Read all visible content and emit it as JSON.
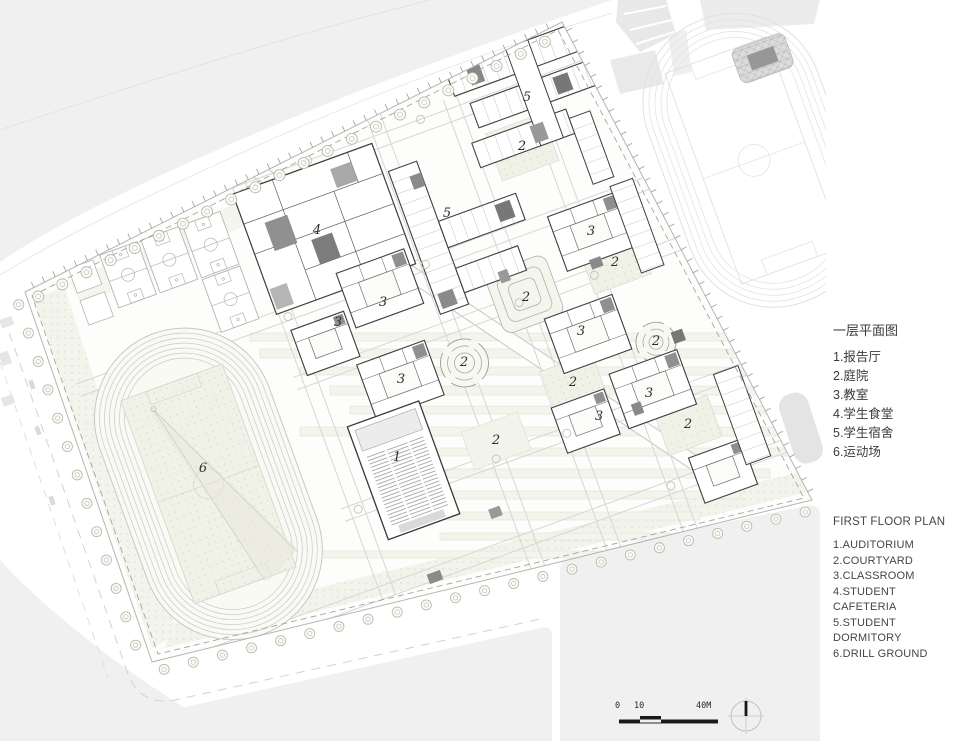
{
  "legend_zh": {
    "title": "一层平面图",
    "items": [
      "1.报告厅",
      "2.庭院",
      "3.教室",
      "4.学生食堂",
      "5.学生宿舍",
      "6.运动场"
    ]
  },
  "legend_en": {
    "title": "FIRST FLOOR PLAN",
    "items": [
      "1.AUDITORIUM",
      "2.COURTYARD",
      "3.CLASSROOM",
      "4.STUDENT CAFETERIA",
      "5.STUDENT DORMITORY",
      "6.DRILL GROUND"
    ]
  },
  "plan_labels": [
    {
      "text": "1",
      "x": 397,
      "y": 458
    },
    {
      "text": "2",
      "x": 522,
      "y": 147
    },
    {
      "text": "2",
      "x": 615,
      "y": 263
    },
    {
      "text": "2",
      "x": 526,
      "y": 298
    },
    {
      "text": "2",
      "x": 656,
      "y": 342
    },
    {
      "text": "2",
      "x": 464,
      "y": 363
    },
    {
      "text": "2",
      "x": 573,
      "y": 383
    },
    {
      "text": "2",
      "x": 688,
      "y": 425
    },
    {
      "text": "2",
      "x": 496,
      "y": 441
    },
    {
      "text": "3",
      "x": 591,
      "y": 232
    },
    {
      "text": "3",
      "x": 383,
      "y": 303
    },
    {
      "text": "3",
      "x": 338,
      "y": 323
    },
    {
      "text": "3",
      "x": 581,
      "y": 332
    },
    {
      "text": "3",
      "x": 401,
      "y": 380
    },
    {
      "text": "3",
      "x": 649,
      "y": 394
    },
    {
      "text": "3",
      "x": 599,
      "y": 417
    },
    {
      "text": "4",
      "x": 317,
      "y": 231
    },
    {
      "text": "5",
      "x": 527,
      "y": 98
    },
    {
      "text": "5",
      "x": 447,
      "y": 214
    },
    {
      "text": "6",
      "x": 203,
      "y": 469
    }
  ],
  "scale_bar": {
    "marks": [
      "0",
      "10",
      "40M"
    ]
  },
  "colors": {
    "context_gray": "#efefef",
    "landscape_tint": "#f1f2e7",
    "line_dark": "#3d3d3d",
    "line_light": "#c9c9c9",
    "core_gray": "#8d8d8d"
  }
}
